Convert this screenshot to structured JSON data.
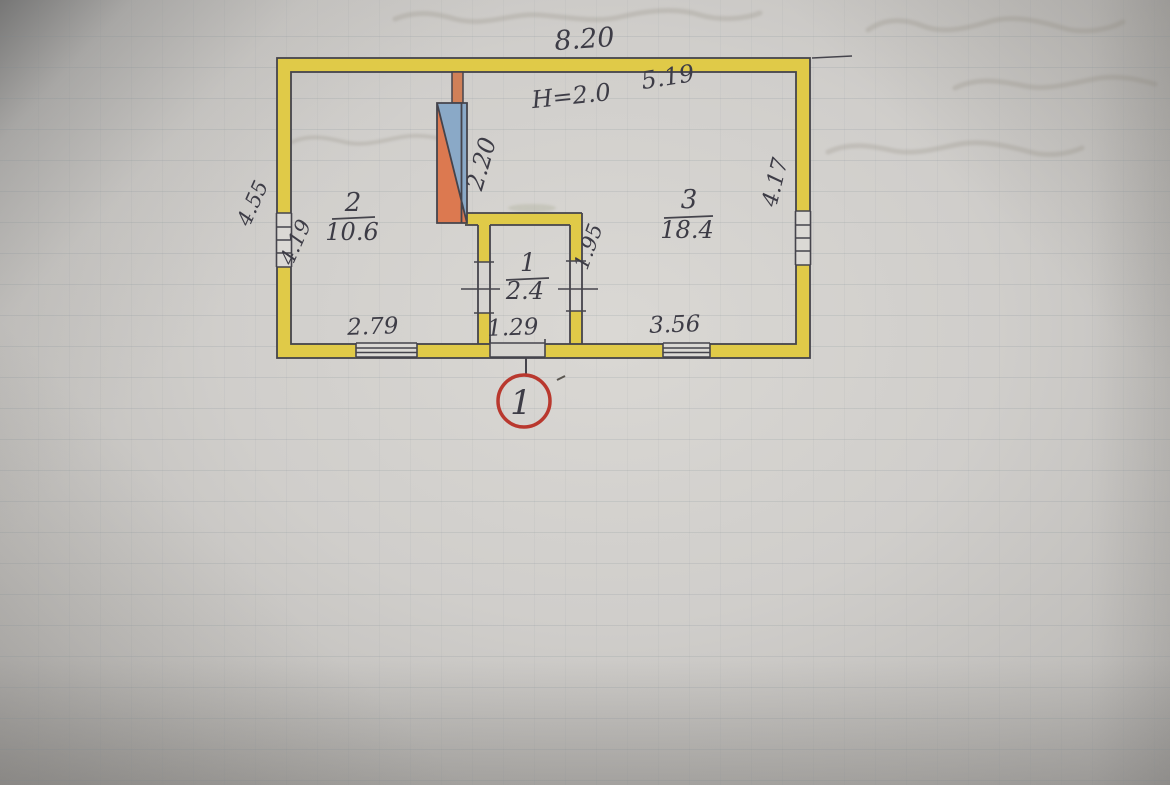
{
  "plan": {
    "dimensions": {
      "overall_width": "8.20",
      "upper_room_inner_width": "5.19",
      "ceiling_height_note": "H=2.0",
      "stove_wall_height": "2.20",
      "left_outer_height": "4.55",
      "left_inner_height": "4.19",
      "right_inner_height": "4.17",
      "hall_wall_depth": "1.95",
      "bottom_left_width": "2.79",
      "bottom_center_width": "1.29",
      "bottom_right_width": "3.56"
    },
    "rooms": [
      {
        "number": "2",
        "area": "10.6"
      },
      {
        "number": "1",
        "area": "2.4"
      },
      {
        "number": "3",
        "area": "18.4"
      }
    ],
    "entrance_marker": "1",
    "colors": {
      "wall_yellow": "#e0ca48",
      "stove_blue": "#8aa9c7",
      "stove_orange": "#dc7950",
      "chimney_orange": "#d08058",
      "ink": "#45444c",
      "marker_red": "#b9382e"
    }
  }
}
